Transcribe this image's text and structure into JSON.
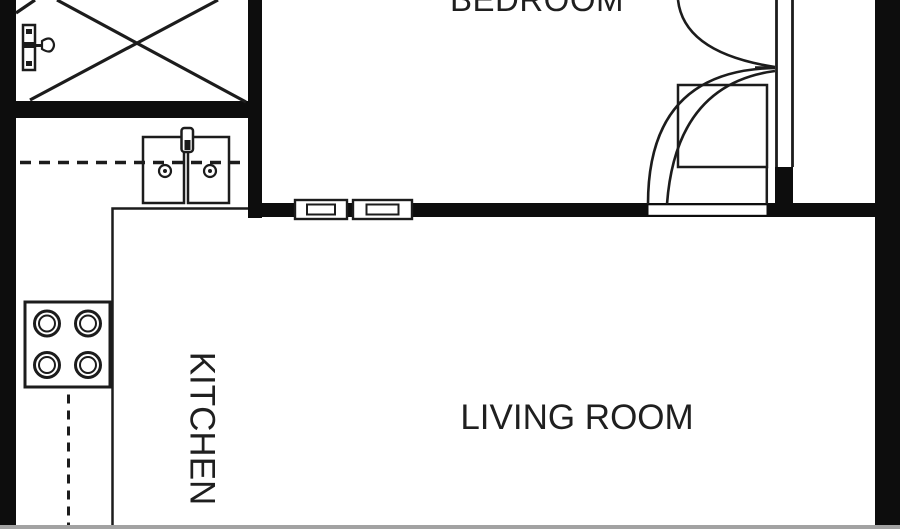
{
  "canvas": {
    "width": 900,
    "height": 529,
    "background": "#ffffff",
    "bottom_edge_color": "#a2a2a2"
  },
  "colors": {
    "wall": "#0d0d0d",
    "line": "#1c1c1c",
    "text": "#1f1f1f",
    "fixture_fill": "#ffffff"
  },
  "rooms": {
    "bedroom": {
      "label": "BEDROOM"
    },
    "kitchen": {
      "label": "KITCHEN"
    },
    "living_room": {
      "label": "LIVING ROOM"
    }
  },
  "fixtures": [
    "crossed-box-closet",
    "wall-valve",
    "double-basin-sink",
    "sink-faucet",
    "four-burner-stove",
    "counter-edge",
    "cabinet-dashed-line",
    "window-symbol-1",
    "window-symbol-2",
    "bedroom-door-swing",
    "entry-door-swing",
    "pocket-wall",
    "closet-outline"
  ]
}
